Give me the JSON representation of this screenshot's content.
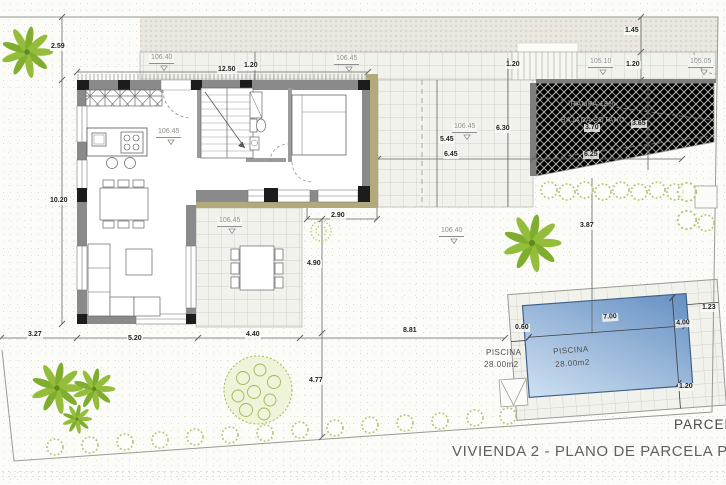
{
  "title": "VIVIENDA 2 - PLANO DE PARCELA P.BAJA",
  "parcel_label": "PARCELA",
  "ramp": {
    "line1": "RAMPA 18%",
    "line2": "BAJADA SÓTANO"
  },
  "pool": {
    "name": "PISCINA",
    "area": "28.00m2"
  },
  "levels": {
    "walkway_left": "106.40",
    "walkway_right": "106.45",
    "street_left": "105.10",
    "street_right": "105.05",
    "interior": "106.45",
    "terrace_east": "106.45",
    "terrace_south": "106.45",
    "garden": "106.40"
  },
  "dimensions": {
    "setback_top": "2.59",
    "house_width": "12.50",
    "walkway_depth": "1.20",
    "plot_left_height": "10.20",
    "street_depth": "1.45",
    "walkway_right_depth": "1.20",
    "steps_width": "1.20",
    "terrace_east_height": "5.45",
    "terrace_east_width": "6.45",
    "ramp_side": "6.30",
    "ramp_width_top": "3.70",
    "ramp_width_right": "3.65",
    "ramp_length": "6.25",
    "garden_east_gap": "3.87",
    "south_opening": "2.90",
    "terrace_south_depth": "4.90",
    "garden_south_depth": "4.77",
    "bottom_seg1": "3.27",
    "bottom_seg2": "5.20",
    "bottom_seg3": "4.40",
    "bottom_seg4": "8.81",
    "pool_length": "7.00",
    "pool_width": "4.00",
    "pool_gap_left": "0.60",
    "pool_gap_right": "1.23",
    "pool_gap_bottom": "1.20"
  }
}
